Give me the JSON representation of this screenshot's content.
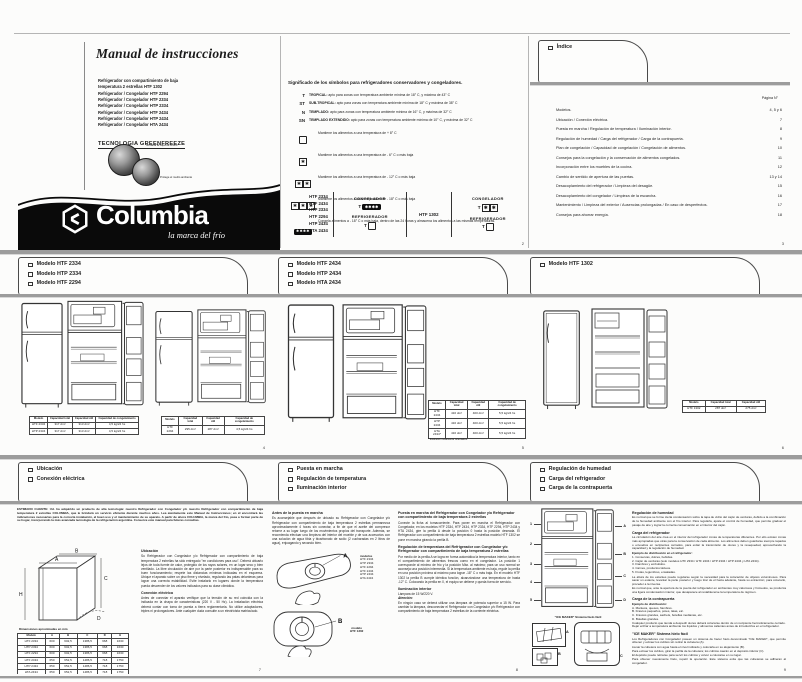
{
  "colors": {
    "brand_band": "#0a0a0a",
    "rule_gray": "#9c9c9c"
  },
  "cover": {
    "title": "Manual de instrucciones",
    "product_lines": [
      "Refrigerador con compartimiento de baja",
      "temperatura 2 estrellas HTF 1302",
      "Refrigerador / Congelador HTF 2294",
      "Refrigerador / Congelador HTF 2334",
      "Refrigerador / Congelador HTP 2334",
      "Refrigerador / Congelador HTF 2434",
      "Refrigerador / Congelador HTP 2434",
      "Refrigerador / Congelador HTA 2434"
    ],
    "technology": "TECNOLOGIA GREENFREEZE",
    "globe_caption_1": "No daña la capa de ozono",
    "globe_caption_2": "Protege el medio ambiente",
    "brand": "Columbia",
    "tagline": "la marca del frío"
  },
  "symbols": {
    "title": "Significado de los símbolos para refrigeradores conservadores y congeladores.",
    "climate": [
      {
        "code": "T",
        "name": "TROPICAL:",
        "desc": "apto para zonas con temperatura ambiente mínima de 18° C, y máxima de 43° C"
      },
      {
        "code": "ST",
        "name": "SUB-TROPICAL:",
        "desc": "apto para zonas con temperatura ambiente mínima de 18° C y máxima de 38° C"
      },
      {
        "code": "N",
        "name": "TEMPLADO:",
        "desc": "apto para zonas con temperatura ambiente mínima de 16° C, y máxima de 32° C"
      },
      {
        "code": "SN",
        "name": "TEMPLADO EXTENDIDO:",
        "desc": "apto para zonas con temperatura ambiente mínima de 10° C, y máxima de 32° C"
      }
    ],
    "stars": [
      {
        "desc": "Mantiene los alimentos a una temperatura de + 8° C"
      },
      {
        "desc": "Mantiene los alimentos a una temperatura de - 6° C o más baja"
      },
      {
        "desc": "Mantiene los alimentos a una temperatura de - 12° C o más baja"
      },
      {
        "desc": "Mantiene los alimentos a una temperatura de - 18° C o más baja"
      },
      {
        "desc": "Congela alimentos a - 18° C o más baja, dentro de las 24 horas y almacena los alimentos a las mismas temperaturas."
      }
    ],
    "matrix": {
      "models_left": [
        "HTF 2334",
        "HTF 2434",
        "HTP 2334",
        "HTF 2294",
        "HTP 2434",
        "HTA 2434"
      ],
      "congelador_label": "CONGELADOR",
      "refrigerador_label": "REFRIGERADOR",
      "t_label": "T",
      "model_right": "HTF 1302"
    },
    "page_number": "2"
  },
  "indice": {
    "tab": "Índice",
    "col_header": "Página N°",
    "entries": [
      {
        "label": "Modelos.",
        "page": "4, 5 y 6"
      },
      {
        "label": "Ubicación / Conexión eléctrica.",
        "page": "7"
      },
      {
        "label": "Puesta en marcha / Regulación de temperatura / Iluminación interior.",
        "page": "8"
      },
      {
        "label": "Regulación de humedad / Carga del refrigerador / Carga de la contrapuerta.",
        "page": "9"
      },
      {
        "label": "Plan de congelación / Capacidad de congelación / Congelación de alimentos.",
        "page": "10"
      },
      {
        "label": "Consejos para la congelación y la conservación de alimentos congelados.",
        "page": "11"
      },
      {
        "label": "Incorporación entre los muebles de la cocina.",
        "page": "12"
      },
      {
        "label": "Cambio de sentido de apertura de las puertas.",
        "page": "13 y 14"
      },
      {
        "label": "Desacoplamiento del refrigerador / Limpieza del desagüe.",
        "page": "15"
      },
      {
        "label": "Desacoplamiento del congelador / Limpieza de la escarcha.",
        "page": "16"
      },
      {
        "label": "Mantenimiento / Limpieza del exterior / Ausencias prolongadas / En caso de desperfectos.",
        "page": "17"
      },
      {
        "label": "Consejos para ahorrar energía.",
        "page": "18"
      }
    ],
    "page_number": "3"
  },
  "models": {
    "cap_headers": [
      "Modelo",
      "Capacidad total",
      "Capacidad útil",
      "Capacidad de congelamiento"
    ],
    "cap_headers_short": [
      "Modelo",
      "Capacidad total",
      "Capacidad útil"
    ],
    "p4": {
      "tab": [
        "Modelo HTF 2334",
        "Modelo HTP 2334",
        "Modelo HTF 2294"
      ],
      "t1_rows": [
        [
          "HTF 2334",
          "317 dm³",
          "313 dm³",
          "4,5 kg/24 hs"
        ],
        [
          "HTP 2334",
          "317 dm³",
          "313 dm³",
          "4,5 kg/24 hs"
        ]
      ],
      "t2_rows": [
        [
          "HTF 2294",
          "295 dm³",
          "287 dm³",
          "4,5 kg/24 hs"
        ]
      ],
      "page_number": "4"
    },
    "p5": {
      "tab": [
        "Modelo HTF 2434",
        "Modelo HTP 2434",
        "Modelo HTA 2434"
      ],
      "rows": [
        [
          "HTF 2434",
          "416 dm³",
          "400 dm³",
          "5,5 kg/24 hs"
        ],
        [
          "HTP 2434",
          "416 dm³",
          "400 dm³",
          "5,5 kg/24 hs"
        ],
        [
          "HTA 2434*",
          "416 dm³",
          "400 dm³",
          "5,5 kg/24 hs"
        ]
      ],
      "footnote": "* Ilustración solamente orientativa.",
      "page_number": "5"
    },
    "p6": {
      "tab": [
        "Modelo HTF 1302"
      ],
      "rows": [
        [
          "HTF 1302",
          "287 dm³",
          "275 dm³"
        ]
      ],
      "page_number": "6"
    }
  },
  "location": {
    "tab": [
      "Ubicación",
      "Conexión eléctrica"
    ],
    "intro": "ESTIMADO CLIENTE: Ud. ha adquirido un producto de alta tecnología: nuestro Refrigerador con Congelador y/o nuestro Refrigerador con compartimiento de baja temperatura 2 estrellas COLUMBIA, que le brindará un servicio eficiente durante muchos años. Lea atentamente este Manual de Instrucciones; en él encontrará las indicaciones necesarias para la correcta instalación, el buen uso y el mantenimiento de su aparato. A partir de ahora COLUMBIA, la marca del frío, pasa a formar parte de su hogar, incorporando la más avanzada tecnología de la refrigeración argentina. Conserve este manual para futuras consultas.",
    "ubicacion_title": "Ubicación",
    "ubicacion_text": "Su Refrigerador con Congelador y/o Refrigerador con compartimiento de baja temperatura 2 estrellas ha sido entregado \"en condiciones para uso\". Deberá ubicarlo lejos de toda fuente de calor, protegido de los rayos solares, en un lugar seco y bien ventilado. La libre circulación de aire por la parte posterior es indispensable para su buen funcionamiento; respete las distancias mínimas indicadas en el esquema. Ubique el aparato sobre un piso firme y nivelado, regulando las patas delanteras para lograr una correcta estabilidad. Evite instalarlo en lugares donde la temperatura pueda descender de los valores indicados para su clase climática.",
    "conexion_title": "Conexión eléctrica",
    "conexion_text": "Antes de conectar el aparato verifique que la tensión de su red coincida con la indicada en la chapa de características (220 V - 50 Hz). La instalación eléctrica deberá contar con toma de puesta a tierra reglamentaria. No utilice adaptadores, triples ni prolongadores. Ante cualquier duda consulte a un electricista matriculado.",
    "dim_title": "Dimensiones aproximadas en mm",
    "dim_headers": [
      "Modelo",
      "A",
      "B",
      "C",
      "D",
      "H"
    ],
    "dim_rows": [
      [
        "HTF 2334",
        "600",
        "602,5",
        "1386,5",
        "668",
        "1630"
      ],
      [
        "HTP 2334",
        "600",
        "602,5",
        "1386,5",
        "668",
        "1630"
      ],
      [
        "HTF 2294",
        "600",
        "602,5",
        "1386,5",
        "668",
        "1630"
      ],
      [
        "HTF 2434",
        "650",
        "652,5",
        "1486,5",
        "718",
        "1750"
      ],
      [
        "HTP 2434",
        "650",
        "652,5",
        "1486,5",
        "718",
        "1750"
      ],
      [
        "HTA 2434",
        "650",
        "652,5",
        "1486,5",
        "718",
        "1750"
      ],
      [
        "HTF 1302",
        "600",
        "602,5",
        "1386,5",
        "668",
        "1445"
      ]
    ],
    "dim_labels": [
      "A",
      "B",
      "C",
      "D",
      "H"
    ],
    "page_number": "7"
  },
  "startup": {
    "tab": [
      "Puesta en marcha",
      "Regulación de temperatura",
      "Iluminación interior"
    ],
    "antes_title": "Antes de la puesta en marcha",
    "antes_text": "Es aconsejable que después de ubicado su Refrigerador con Congelador y/o Refrigerador con compartimiento de baja temperatura 2 estrellas permanezca aproximadamente 4 horas sin conectar, a fin de que el aceite del compresor retorne a su lugar luego de los movimientos propios del transporte. Además, se recomienda efectuar una limpieza del interior del mueble y de sus accesorios con una solución de agua tibia y bicarbonato de sodio (2 cucharadas en 2 litros de agua), enjuagando y secando bien.",
    "modelos_label": "modelos",
    "modelos_list": [
      "HTF 2334",
      "HTP 2334",
      "HTF 2294",
      "HTF 2434",
      "HTP 2434",
      "HTA 2434"
    ],
    "modelo_b_line1": "modelo",
    "modelo_b_line2": "HTF 1302",
    "knob_a_label": "A",
    "knob_b_label": "B",
    "puesta_title": "Puesta en marcha del Refrigerador con Congelador y/o Refrigerador con compartimiento de baja temperatura 2 estrellas",
    "puesta_text": "Conecte la ficha al tomacorriente. Para poner en marcha el Refrigerador con Congelador, en los modelos HTF 2334, HTF 2434, HTP 2334, HTF 2294, HTP 2434 y HTA 2434, gire la perilla A desde la posición 0 hasta la posición deseada. El Refrigerador con compartimiento de baja temperatura 2 estrellas modelo HTF 1302 se pone en marcha girando la perilla B.",
    "regulacion_title": "Regulación de temperatura del Refrigerador con Congelador y/o Refrigerador con compartimiento de baja temperatura 2 estrellas",
    "regulacion_text": "Por medio de la perilla A se logra en forma automática la temperatura interior, tanto en el compartimiento de alimentos frescos como en el congelador. La posición 1 corresponde al mínimo de frío y la posición Máx. al máximo; para un uso normal se aconseja una posición intermedia. Si la temperatura ambiente es baja, regule la perilla en una posición próxima al máximo para lograr -18° C o más baja. En el modelo HTF 1302 la perilla B cumple idéntica función, alcanzándose una temperatura de hasta -12° C. Colocando la perilla en 0, el equipo se detiene y queda fuera de servicio.",
    "ilum_title": "Iluminación interior",
    "lamp_text": "Lámpara de 15 W/220 V.",
    "atencion_label": "Atención:",
    "atencion_text": "En ningún caso se deberá utilizar una lámpara de potencia superior a 15 W. Para cambiar la lámpara, desconectar el Refrigerador con Congelador y/o Refrigerador con compartimiento de baja temperatura 2 estrellas de la corriente eléctrica.",
    "page_number": "8"
  },
  "humidity": {
    "tab": [
      "Regulación de humedad",
      "Carga del refrigerador",
      "Carga de la contrapuerta"
    ],
    "reg_title": "Regulación de humedad",
    "reg_text": "Es normal que se forme cierta condensación sobre la tapa de vidrio del cajón de verduras, debido a la combinación de la humedad ambiente con el frío interior. Para regularla, ajuste el control de humedad, que permite graduar el pasaje de aire y lograr la correcta conservación en el interior del cajón.",
    "carga_title": "Carga del refrigerador",
    "carga_text": "La circulación del aire crea en el interior del refrigerador zonas de temperaturas diferentes. Por ello existen zonas más apropiadas que otras para la conservación de cada alimento. Los alimentos deben guardarse siempre tapados o envueltos en recipientes cerrados, para evitar la transmisión de olores y la resequedad, aprovechando la capacidad y la regulación de humedad.",
    "ejemplo_label": "Ejemplo de distribución en el refrigerador:",
    "dist_items": [
      "1. Conservas, dulces, bebidas.",
      "2. Cajón de verduras (solo modelos HTF 2334 / HTF 2434 / HTP 2334 / HTP 2434 y HTA 2434).",
      "3. Fiambres y embutidos.",
      "4. Carnes, productos lácteos.",
      "5. Frutas, legumbres, ensaladas."
    ],
    "after_text_1": "La altura de los estantes puede regularse según la necesidad para la colocación de objetos voluminosos. Para sacar un estante, levantar la parte posterior y luego tirar de él hacia adelante, hasta su extracción; para colocarlo, proceder a la inversa.",
    "after_text_2": "Es normal que, ante la apertura de la puerta del refrigerador en ambientes muy calurosos y húmedos, se produzca una ligera condensación interior, que desaparece al restablecerse la temperatura de régimen.",
    "contra_title": "Carga de la contrapuerta",
    "contra_label": "Ejemplo de distribución:",
    "contra_items": [
      "A. Manteca, quesos, fiambres.",
      "B. Frascos pequeños, potes, latas, etc.",
      "C. Frascos grandes, sachets, botellas medianas, etc.",
      "D. Botellas grandes."
    ],
    "contra_after_1": "Cualquier producto que tienda a despedir olores deberá colocarse dentro de un recipiente herméticamente cerrado.",
    "contra_after_2": "Dejar enfriar a temperatura ambiente los líquidos y alimentos calientes antes de introducirlos en el refrigerador.",
    "ice_title": "\"ICE MAKER\" Sistema hielo fácil",
    "ice_caption": "\"ICE MAKER\" Sistema hielo fácil",
    "ice_items": [
      "Los Refrigeradores con Congelador poseen un sistema de hacer hielo denominado \"ICE MAKER\", que permite obtener y extraer los cubitos sin retirar la cubetera (A).",
      "Llenar la cubetera con agua hasta el nivel indicado y colocarla en su alojamiento (B).",
      "Para extraer los cubitos, girar la perilla de la cubetera; los cubitos caerán en el depósito inferior (C).",
      "El depósito puede retirarse para servir los cubitos y volver a colocarse en su lugar.",
      "Para obtener nuevamente hielo, repetir la operación. Este sistema evita que las cubeteras se adhieran al congelador."
    ],
    "callout_numbers": [
      "1",
      "2",
      "3",
      "4",
      "5"
    ],
    "callout_letters": [
      "A",
      "B",
      "C",
      "D"
    ],
    "box_labels": [
      "A",
      "B",
      "C"
    ],
    "page_number": "9"
  }
}
